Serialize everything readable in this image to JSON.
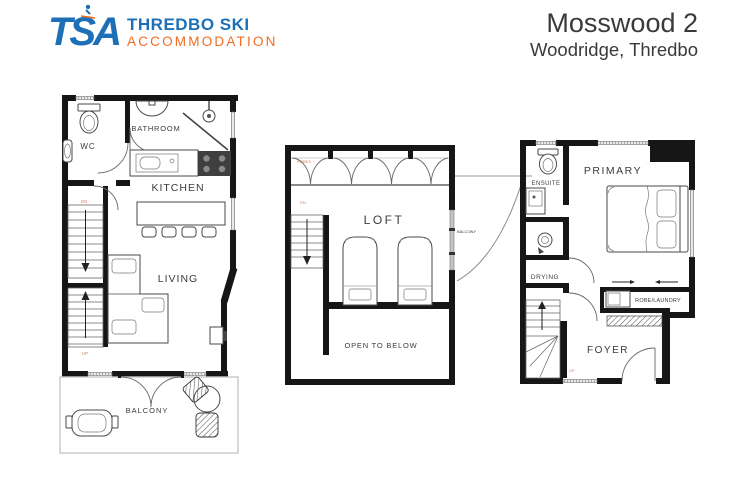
{
  "header": {
    "logo": {
      "tsa": "TSA",
      "line1": "THREDBO SKI",
      "line2": "ACCOMMODATION"
    },
    "title": "Mosswood 2",
    "subtitle": "Woodridge, Thredbo"
  },
  "colors": {
    "brand_blue": "#1d70b7",
    "brand_orange": "#f26b21",
    "ink": "#3a3a3a",
    "wall": "#161616",
    "annotation_red": "#d2806e"
  },
  "plans": {
    "living": {
      "wc": "WC",
      "bathroom": "BATHROOM",
      "kitchen": "KITCHEN",
      "living": "LIVING",
      "balcony": "BALCONY",
      "dn": "DN",
      "up": "UP"
    },
    "loft": {
      "loft": "LOFT",
      "open_to_below": "OPEN TO BELOW",
      "balcony": "BALCONY",
      "robes": "ROBES",
      "dn": "DN"
    },
    "entry": {
      "primary": "PRIMARY",
      "ensuite": "ENSUITE",
      "drying": "DRYING",
      "robe_laundry": "ROBE/LAUNDRY",
      "foyer": "FOYER",
      "up": "UP"
    }
  }
}
